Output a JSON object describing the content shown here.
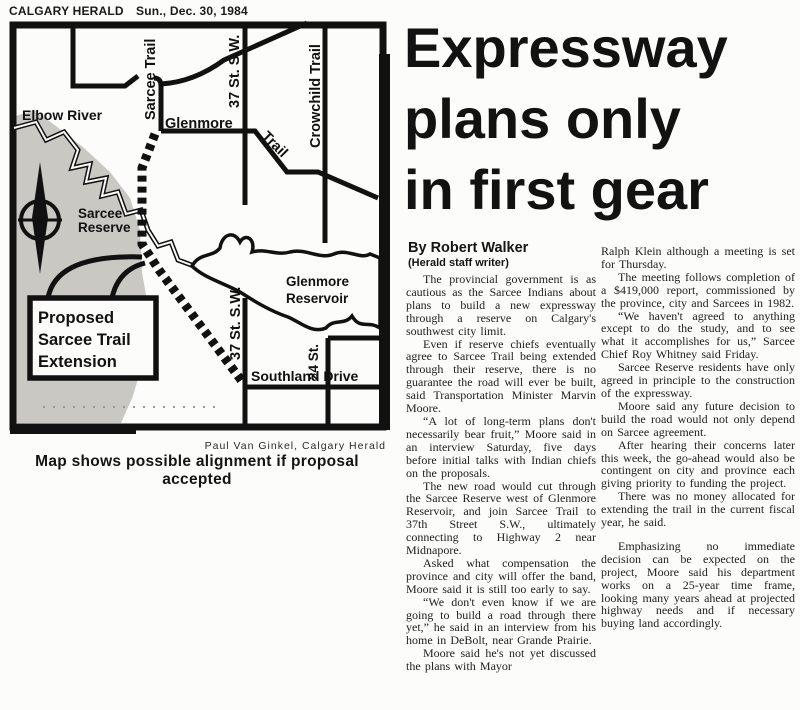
{
  "colors": {
    "ink": "#1a1a1a",
    "paper": "#fcfcfa",
    "map_gray": "#c9c8c2"
  },
  "header": {
    "publication": "CALGARY HERALD",
    "date": "Sun., Dec. 30, 1984"
  },
  "map": {
    "labels": {
      "sarcee_trail": "Sarcee Trail",
      "st37": "37 St. S.W.",
      "crowchild": "Crowchild Trail",
      "glenmore_road": "Glenmore",
      "trail_word": "Trail",
      "elbow_river": "Elbow River",
      "reserve_line1": "Sarcee",
      "reserve_line2": "Reserve",
      "reservoir_line1": "Glenmore",
      "reservoir_line2": "Reservoir",
      "st24": "24 St.",
      "southland": "Southland Drive",
      "callout_line1": "Proposed",
      "callout_line2": "Sarcee Trail",
      "callout_line3": "Extension",
      "compass_n": "N"
    },
    "credit": "Paul Van Ginkel, Calgary Herald",
    "caption": "Map shows possible alignment if proposal accepted"
  },
  "article": {
    "headline_lines": [
      "Expressway",
      "plans only",
      "in first gear"
    ],
    "byline": "By Robert Walker",
    "byline_sub": "(Herald staff writer)",
    "col1": [
      "The provincial government is as cautious as the Sarcee Indians about plans to build a new expressway through a reserve on Calgary's southwest city limit.",
      "Even if reserve chiefs eventually agree to Sarcee Trail being extended through their reserve, there is no guarantee the road will ever be built, said Transportation Minister Marvin Moore.",
      "“A lot of long-term plans don't necessarily bear fruit,” Moore said in an interview Saturday, five days before initial talks with Indian chiefs on the proposals.",
      "The new road would cut through the Sarcee Reserve west of Glenmore Reservoir, and join Sarcee Trail to 37th Street S.W., ultimately connecting to Highway 2 near Midnapore.",
      "Asked what compensation the province and city will offer the band, Moore said it is still too early to say.",
      "“We don't even know if we are going to build a road through there yet,” he said in an interview from his home in DeBolt, near Grande Prairie.",
      "Moore said he's not yet discussed the plans with Mayor"
    ],
    "col2": [
      "Ralph Klein although a meeting is set for Thursday.",
      "The meeting follows completion of a $419,000 report, commissioned by the province, city and Sarcees in 1982.",
      "“We haven't agreed to anything except to do the study, and to see what it accomplishes for us,” Sarcee Chief Roy Whitney said Friday.",
      "Sarcee Reserve residents have only agreed in principle to the construction of the expressway.",
      "Moore said any future decision to build the road would not only depend on Sarcee agreement.",
      "After hearing their concerns later this week, the go-ahead would also be contingent on city and province each giving priority to funding the project.",
      "There was no money allocated for extending the trail in the current fiscal year, he said.",
      "Emphasizing no immediate decision can be expected on the project, Moore said his department works on a 25-year time frame, looking many years ahead at projected highway needs and if necessary buying land accordingly."
    ]
  }
}
